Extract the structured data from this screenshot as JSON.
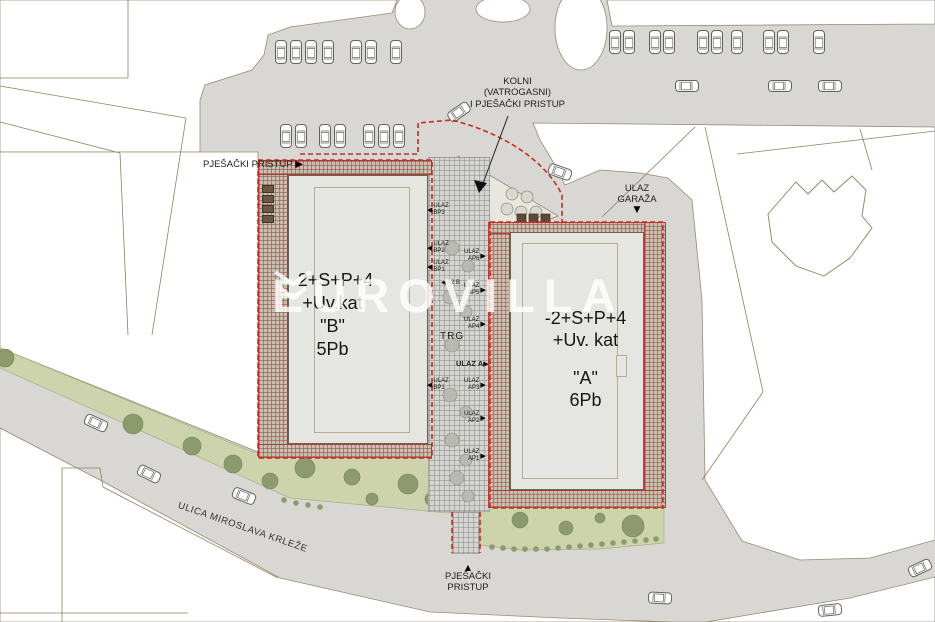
{
  "watermark": "EUROVILLA",
  "annotations": {
    "access_top": {
      "line1": "KOLNI",
      "line2": "(VATROGASNI)",
      "line3": "I PJEŠAČKI PRISTUP"
    },
    "pedestrian_left": "PJEŠAČKI PRISTUP",
    "garage": {
      "line1": "ULAZ",
      "line2": "GARAŽA"
    },
    "pedestrian_bottom": {
      "line1": "PJEŠAČKI",
      "line2": "PRISTUP"
    },
    "street": "ULICA MIROSLAVA KRLEŽE",
    "square": "TRG",
    "entrance_a_main": "ULAZ A",
    "section": "A2 B"
  },
  "building_b": {
    "floors": "-2+S+P+4",
    "attic": "+Uv.kat",
    "name": "\"B\"",
    "units": "5Pb"
  },
  "building_a": {
    "floors": "-2+S+P+4",
    "attic": "+Uv. kat",
    "name": "\"A\"",
    "units": "6Pb"
  },
  "entrances_b": [
    {
      "word": "ULAZ",
      "code": "BP3"
    },
    {
      "word": "ULAZ",
      "code": "BP2"
    },
    {
      "word": "ULAZ",
      "code": "BP1"
    },
    {
      "word": "ULAZ",
      "code": "BP1"
    }
  ],
  "entrances_a": [
    {
      "word": "ULAZ",
      "code": "AP6"
    },
    {
      "word": "ULAZ",
      "code": "AP5"
    },
    {
      "word": "ULAZ",
      "code": "AP4"
    },
    {
      "word": "ULAZ",
      "code": "AP3"
    },
    {
      "word": "ULAZ",
      "code": "AP2"
    },
    {
      "word": "ULAZ",
      "code": "AP1"
    }
  ],
  "colors": {
    "site_boundary": "#cb2a1e",
    "hatch_red": "#ac3e32",
    "road_gray": "#d8d7d4",
    "green": "#ccd3ad"
  }
}
